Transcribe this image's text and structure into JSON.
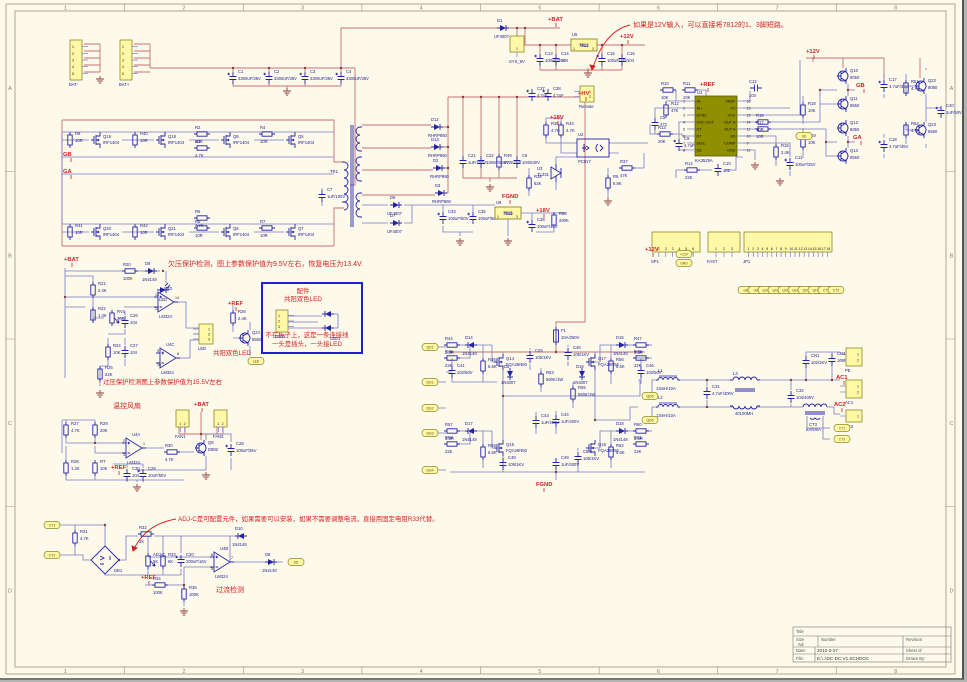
{
  "sheet": {
    "zones_top": [
      "1",
      "2",
      "3",
      "4",
      "5",
      "6",
      "7",
      "8"
    ],
    "zones_side": [
      "A",
      "B",
      "C",
      "D"
    ],
    "accent_red": "#d42020",
    "wire_blue": "#7878c8",
    "wire_red": "#c87070",
    "connector_yellow": "#fff8a6",
    "ic_olive": "#8f8f00"
  },
  "annotations": {
    "note_12v": "如果是12V输入，可以直接将7812的1、3脚短路。",
    "note_uv": "欠压保护检测，图上参数保护值为9.5V左右，恢复电压为13.4V.",
    "note_ov": "过压保护检测图上参数保护值为15.5V左右",
    "lbl_led": "共阳双色LED",
    "fan_title": "温控风扇",
    "note_adj": "ADJ-C是可配置元件，如果需要可以安装，如果不需要调整电流，直接用固定电阻R33代替。",
    "oc_title": "过流检测",
    "box_t1": "配件",
    "box_t2": "共阳双色LED",
    "box_n1": "不在板子上，这是一条连接线",
    "box_n2": "一头是插头，一头接LED",
    "box_led1": "LED1"
  },
  "ic": {
    "ref": "U1",
    "name": "KA3525A",
    "left_pins": [
      [
        "IN-",
        "1"
      ],
      [
        "IN+",
        "2"
      ],
      [
        "SYNC",
        "3"
      ],
      [
        "OSC OUT",
        "4"
      ],
      [
        "CT",
        "5"
      ],
      [
        "RT",
        "6"
      ],
      [
        "DISC",
        "7"
      ],
      [
        "SS",
        "8"
      ]
    ],
    "right_pins": [
      [
        "VREF",
        "16"
      ],
      [
        "VC",
        "13"
      ],
      [
        "VCC",
        "15"
      ],
      [
        "OUT B",
        "14"
      ],
      [
        "OUT A",
        "11"
      ],
      [
        "SD",
        "10"
      ],
      [
        "COMP",
        "9"
      ],
      [
        "GND",
        "12"
      ]
    ]
  },
  "parts": [
    {
      "r": "C1",
      "v": "3300uF/35V"
    },
    {
      "r": "C2",
      "v": "3300uF/35V"
    },
    {
      "r": "C3",
      "v": "3300uF/35V"
    },
    {
      "r": "C4",
      "v": "3300uF/35V"
    },
    {
      "r": "R9",
      "v": "10R"
    },
    {
      "r": "Q19",
      "v": "IRF1404"
    },
    {
      "r": "R40",
      "v": "10R"
    },
    {
      "r": "Q18",
      "v": "IRF1404"
    },
    {
      "r": "R2",
      "v": "10R"
    },
    {
      "r": "R3",
      "v": "4.7K"
    },
    {
      "r": "Q8",
      "v": "IRF1404"
    },
    {
      "r": "R4",
      "v": "10R"
    },
    {
      "r": "Q5",
      "v": "IRF1404"
    },
    {
      "r": "R41",
      "v": "10R"
    },
    {
      "r": "Q20",
      "v": "IRF1404"
    },
    {
      "r": "R42",
      "v": "10R"
    },
    {
      "r": "Q21",
      "v": "IRF1404"
    },
    {
      "r": "R5",
      "v": "4.7K"
    },
    {
      "r": "R6",
      "v": "10R"
    },
    {
      "r": "Q6",
      "v": "IRF1404"
    },
    {
      "r": "R7",
      "v": "10R"
    },
    {
      "r": "Q7",
      "v": "IRF1404"
    },
    {
      "r": "C7",
      "v": "1uF/100V"
    },
    {
      "r": "TR1",
      "v": ""
    },
    {
      "r": "D12",
      "v": "RHRP860"
    },
    {
      "r": "D13",
      "v": "RHRP860"
    },
    {
      "r": "D2",
      "v": "RHRP860"
    },
    {
      "r": "D3",
      "v": "RHRP860"
    },
    {
      "r": "C21",
      "v": "1uF/400V"
    },
    {
      "r": "C22",
      "v": "330nF/630V"
    },
    {
      "r": "R49",
      "v": "470K/2W"
    },
    {
      "r": "C8",
      "v": "104/630V"
    },
    {
      "r": "D6",
      "v": "UF4007"
    },
    {
      "r": "D7",
      "v": "UF4007"
    },
    {
      "r": "C33",
      "v": "100uF/50V"
    },
    {
      "r": "C35",
      "v": "100uF/50V"
    },
    {
      "r": "U6",
      "v": "7815"
    },
    {
      "r": "C36",
      "v": "100uF/35V"
    },
    {
      "r": "R50",
      "v": "200K"
    },
    {
      "r": "D1",
      "v": "UF4007"
    },
    {
      "r": "U5",
      "v": "7812"
    },
    {
      "r": "C13",
      "v": "100uF/35V"
    },
    {
      "r": "C14",
      "v": "104"
    },
    {
      "r": "C15",
      "v": "100uF/16V"
    },
    {
      "r": "C16",
      "v": "104"
    },
    {
      "r": "C37",
      "v": "4.7uF"
    },
    {
      "r": "C38",
      "v": "4.7uF"
    },
    {
      "r": "R10",
      "v": "10K"
    },
    {
      "r": "R11",
      "v": "10K"
    },
    {
      "r": "C5",
      "v": "472"
    },
    {
      "r": "R12",
      "v": "47K"
    },
    {
      "r": "R13",
      "v": "20K"
    },
    {
      "r": "C9",
      "v": "4.7uF"
    },
    {
      "r": "R14",
      "v": "22K"
    },
    {
      "r": "C10",
      "v": "102"
    },
    {
      "r": "C12",
      "v": "104"
    },
    {
      "r": "R16",
      "v": "10R"
    },
    {
      "r": "R17",
      "v": "10R"
    },
    {
      "r": "R15",
      "v": "2.4K"
    },
    {
      "r": "C11",
      "v": "100uF/25V"
    },
    {
      "r": "R39",
      "v": "4.7K"
    },
    {
      "r": "R43",
      "v": "4.7K"
    },
    {
      "r": "U2",
      "v": "PC817"
    },
    {
      "r": "U3",
      "v": "TL431"
    },
    {
      "r": "R37",
      "v": "47K"
    },
    {
      "r": "R8",
      "v": "6.8K"
    },
    {
      "r": "R38",
      "v": "62K"
    },
    {
      "r": "R18",
      "v": "10K"
    },
    {
      "r": "R19",
      "v": "10K"
    },
    {
      "r": "Q10",
      "v": "8050"
    },
    {
      "r": "Q11",
      "v": "8550"
    },
    {
      "r": "Q12",
      "v": "8050"
    },
    {
      "r": "Q13",
      "v": "8550"
    },
    {
      "r": "C17",
      "v": "4.7uF/35V"
    },
    {
      "r": "C18",
      "v": "4.7uF/35V"
    },
    {
      "r": "R51",
      "v": "4.7K"
    },
    {
      "r": "Q22",
      "v": "8050"
    },
    {
      "r": "R52",
      "v": "4.7K"
    },
    {
      "r": "Q23",
      "v": "8550"
    },
    {
      "r": "C40",
      "v": "1uF/50V"
    },
    {
      "r": "R20",
      "v": "100K"
    },
    {
      "r": "D9",
      "v": "1N4148"
    },
    {
      "r": "LED",
      "v": ""
    },
    {
      "r": "R21",
      "v": "2.4K"
    },
    {
      "r": "R22",
      "v": "1.3K"
    },
    {
      "r": "RV1",
      "v": "20K"
    },
    {
      "r": "C26",
      "v": "104"
    },
    {
      "r": "R24",
      "v": "10K"
    },
    {
      "r": "C27",
      "v": "104"
    },
    {
      "r": "R25",
      "v": "22K"
    },
    {
      "r": "U4D",
      "v": "LM324",
      "p": [
        "12",
        "13",
        "14"
      ]
    },
    {
      "r": "U4C",
      "v": "LM324",
      "p": [
        "10",
        "9",
        "8"
      ]
    },
    {
      "r": "R26",
      "v": "2.4K"
    },
    {
      "r": "Q24",
      "v": "8550"
    },
    {
      "r": "R27",
      "v": "4.7K"
    },
    {
      "r": "R29",
      "v": "20K"
    },
    {
      "r": "R28",
      "v": "1.2K"
    },
    {
      "r": "RT",
      "v": "10K"
    },
    {
      "r": "U4A",
      "v": "LM324",
      "p": [
        "3",
        "2",
        "1"
      ]
    },
    {
      "r": "R30",
      "v": "4.7K"
    },
    {
      "r": "Q9",
      "v": "D882"
    },
    {
      "r": "C28",
      "v": "100uF/35V"
    },
    {
      "r": "C30",
      "v": "104"
    },
    {
      "r": "C29",
      "v": "10uF/50V"
    },
    {
      "r": "R31",
      "v": "4.7K"
    },
    {
      "r": "DB1",
      "v": ""
    },
    {
      "r": "R32",
      "v": "2K"
    },
    {
      "r": "ADJ-C",
      "v": "5K"
    },
    {
      "r": "R33",
      "v": "5K"
    },
    {
      "r": "C20",
      "v": "100uF/16V"
    },
    {
      "r": "R34",
      "v": "100K"
    },
    {
      "r": "R35",
      "v": "100K"
    },
    {
      "r": "U4B",
      "v": "LM324",
      "p": [
        "5",
        "6",
        "7"
      ]
    },
    {
      "r": "D10",
      "v": "1N4148"
    },
    {
      "r": "D8",
      "v": "1N4148"
    },
    {
      "r": "F1",
      "v": "10A/250V"
    },
    {
      "r": "R44",
      "v": "3.3R"
    },
    {
      "r": "D14",
      "v": "1N4148"
    },
    {
      "r": "R45",
      "v": "22K"
    },
    {
      "r": "C41",
      "v": "102/50V"
    },
    {
      "r": "R46",
      "v": "5.6K"
    },
    {
      "r": "Q14",
      "v": "FQA28N50"
    },
    {
      "r": "D5",
      "v": "1N4007"
    },
    {
      "r": "C25",
      "v": "105/1KV"
    },
    {
      "r": "R53",
      "v": "560K/1W"
    },
    {
      "r": "C43",
      "v": "1uF/400V"
    },
    {
      "r": "C44",
      "v": "1uF/400V"
    },
    {
      "r": "R55",
      "v": "560K/1W"
    },
    {
      "r": "C45",
      "v": "105/1KV"
    },
    {
      "r": "R47",
      "v": "3.3R"
    },
    {
      "r": "D15",
      "v": "1N4148"
    },
    {
      "r": "R48",
      "v": "22K"
    },
    {
      "r": "C46",
      "v": "102/50V"
    },
    {
      "r": "R56",
      "v": "5.6K"
    },
    {
      "r": "Q17",
      "v": "FQA28N50"
    },
    {
      "r": "D16",
      "v": "1N4007"
    },
    {
      "r": "R57",
      "v": "3.3R"
    },
    {
      "r": "D17",
      "v": "1N4148"
    },
    {
      "r": "R58",
      "v": "22K"
    },
    {
      "r": "R59",
      "v": "5.6K"
    },
    {
      "r": "Q15",
      "v": "FQA28N50"
    },
    {
      "r": "C48",
      "v": "105/1KV"
    },
    {
      "r": "R60",
      "v": "3.3R"
    },
    {
      "r": "D18",
      "v": "1N4148"
    },
    {
      "r": "R61",
      "v": "22K"
    },
    {
      "r": "R62",
      "v": "5.6K"
    },
    {
      "r": "Q16",
      "v": "FQA28N50"
    },
    {
      "r": "C49",
      "v": "1uF/400V"
    },
    {
      "r": "C50",
      "v": "105/1KV"
    },
    {
      "r": "L1",
      "v": "13mH/10A"
    },
    {
      "r": "L2",
      "v": "13mH/10A"
    },
    {
      "r": "C31",
      "v": "4.7uF/400V"
    },
    {
      "r": "L3",
      "v": "40100MH"
    },
    {
      "r": "C32",
      "v": "104/400V"
    },
    {
      "r": "CN1",
      "v": "102/1KV"
    },
    {
      "r": "CN2",
      "v": "104/1KV"
    },
    {
      "r": "CT3",
      "v": "5A/5mA"
    }
  ],
  "connectors": [
    {
      "label": "BAT-",
      "pins": 5
    },
    {
      "label": "BAT+",
      "pins": 5
    },
    {
      "label": "SYS_9V",
      "pins": 1
    },
    {
      "label": "Remote",
      "pins": 2
    },
    {
      "label": "SP1",
      "pins": 6
    },
    {
      "label": "FAST",
      "pins": 3
    },
    {
      "label": "JP1",
      "pins": 18
    },
    {
      "label": "LED",
      "pins": 3
    },
    {
      "label": "LED3",
      "pins": 3
    },
    {
      "label": "FAN1",
      "pins": 2
    },
    {
      "label": "FAN2",
      "pins": 2
    },
    {
      "label": "PE",
      "pins": 2
    },
    {
      "label": "AC1",
      "pins": 2
    },
    {
      "label": "AC2",
      "pins": 1
    }
  ],
  "ports": [
    "SD",
    "LED",
    "CT1",
    "CT2",
    "SD",
    "QD1",
    "QG1",
    "QG2",
    "QG3",
    "QG4",
    "QD5",
    "QD6",
    "+12V",
    "GND",
    "GB",
    "GA",
    "QG1",
    "QG2",
    "QG3",
    "QG4",
    "QD1",
    "QD3",
    "CT1",
    "CT2",
    "CT1",
    "CT2"
  ],
  "net_labels": [
    "+BAT",
    "+12V",
    "+HV",
    "+REF",
    "+18V",
    "FGND",
    "+18V",
    "+12V",
    "GB",
    "GA",
    "GB",
    "GA",
    "+BAT",
    "+REF",
    "+BAT",
    "+REF",
    "+REF",
    "FGND",
    "AC1",
    "AC2",
    "+12V"
  ],
  "title_block": {
    "title_label": "Title",
    "size_label": "Size",
    "size": "A2",
    "number_label": "Number",
    "revision_label": "Revision",
    "date_label": "Date:",
    "date": "2012-3-27",
    "sheet_label": "Sheet    of",
    "file_label": "File:",
    "file": "E:\\..\\DC-DC V1.SCHDOC",
    "drawn_label": "Drawn By:"
  }
}
